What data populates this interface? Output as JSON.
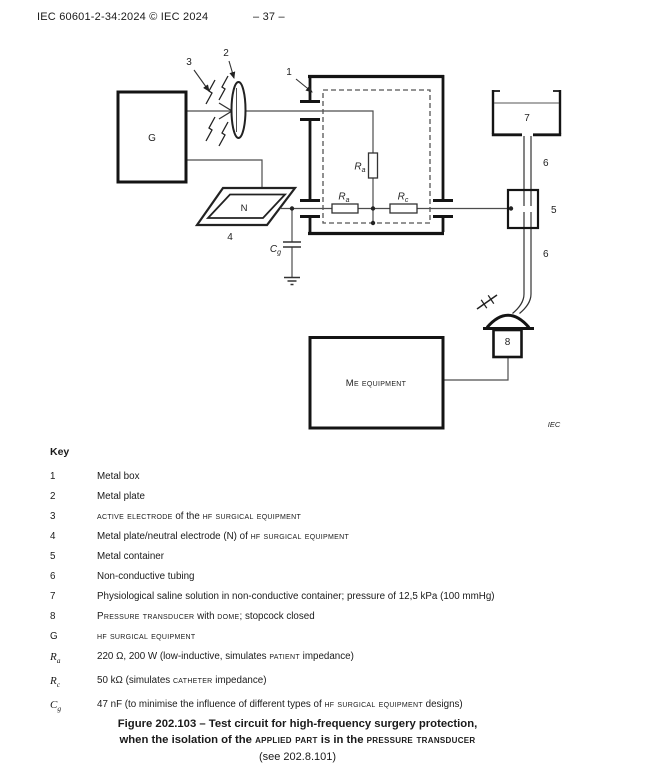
{
  "header": {
    "left": "IEC 60601-2-34:2024 © IEC 2024",
    "page_number": "– 37 –"
  },
  "diagram": {
    "credit": "IEC",
    "labels": {
      "generator": "G",
      "neutral_electrode": "N",
      "callout_1": "1",
      "callout_2": "2",
      "callout_3": "3",
      "callout_4": "4",
      "callout_5": "5",
      "callout_6_upper": "6",
      "callout_6_lower": "6",
      "callout_7": "7",
      "callout_8": "8",
      "resistor_patient_vertical": {
        "base": "R",
        "sub": "a"
      },
      "resistor_patient_horizontal": {
        "base": "R",
        "sub": "a"
      },
      "resistor_catheter": {
        "base": "R",
        "sub": "c"
      },
      "capacitor_ground": {
        "base": "C",
        "sub": "g"
      },
      "me_equipment": [
        [
          "Me equipment",
          "sc"
        ]
      ]
    }
  },
  "key": {
    "title": "Key",
    "rows": [
      {
        "sym": "1",
        "text": [
          [
            "Metal box",
            ""
          ]
        ]
      },
      {
        "sym": "2",
        "text": [
          [
            "Metal plate",
            ""
          ]
        ]
      },
      {
        "sym": "3",
        "text": [
          [
            "active electrode",
            "sc"
          ],
          [
            " of the ",
            ""
          ],
          [
            "hf surgical equipment",
            "sc"
          ]
        ]
      },
      {
        "sym": "4",
        "text": [
          [
            "Metal plate/neutral electrode (N) of ",
            ""
          ],
          [
            "hf surgical equipment",
            "sc"
          ]
        ]
      },
      {
        "sym": "5",
        "text": [
          [
            "Metal container",
            ""
          ]
        ]
      },
      {
        "sym": "6",
        "text": [
          [
            "Non-conductive tubing",
            ""
          ]
        ]
      },
      {
        "sym": "7",
        "text": [
          [
            "Physiological saline solution in non-conductive container; pressure of 12,5 kPa (100 mmHg)",
            ""
          ]
        ]
      },
      {
        "sym": "8",
        "text": [
          [
            "Pressure transducer",
            "sc"
          ],
          [
            " with ",
            ""
          ],
          [
            "dome",
            "sc"
          ],
          [
            "; stopcock closed",
            ""
          ]
        ]
      },
      {
        "sym": "G",
        "text": [
          [
            "hf surgical equipment",
            "sc"
          ]
        ]
      },
      {
        "sym": {
          "base": "R",
          "sub": "a"
        },
        "text": [
          [
            "220 Ω, 200 W (low-inductive, simulates ",
            ""
          ],
          [
            "patient",
            "sc"
          ],
          [
            " impedance)",
            ""
          ]
        ]
      },
      {
        "sym": {
          "base": "R",
          "sub": "c"
        },
        "text": [
          [
            "50 kΩ (simulates ",
            ""
          ],
          [
            "catheter",
            "sc"
          ],
          [
            " impedance)",
            ""
          ]
        ]
      },
      {
        "sym": {
          "base": "C",
          "sub": "g"
        },
        "text": [
          [
            "47 nF (to minimise the influence of different types of ",
            ""
          ],
          [
            "hf surgical equipment",
            "sc"
          ],
          [
            " designs)",
            ""
          ]
        ]
      }
    ]
  },
  "caption": {
    "line1": "Figure 202.103 – Test circuit for high-frequency surgery protection,",
    "line2": [
      [
        "when the isolation of the ",
        ""
      ],
      [
        "applied part",
        "sc"
      ],
      [
        " is in the ",
        ""
      ],
      [
        "pressure transducer",
        "sc"
      ]
    ],
    "line3": "(see 202.8.101)"
  }
}
